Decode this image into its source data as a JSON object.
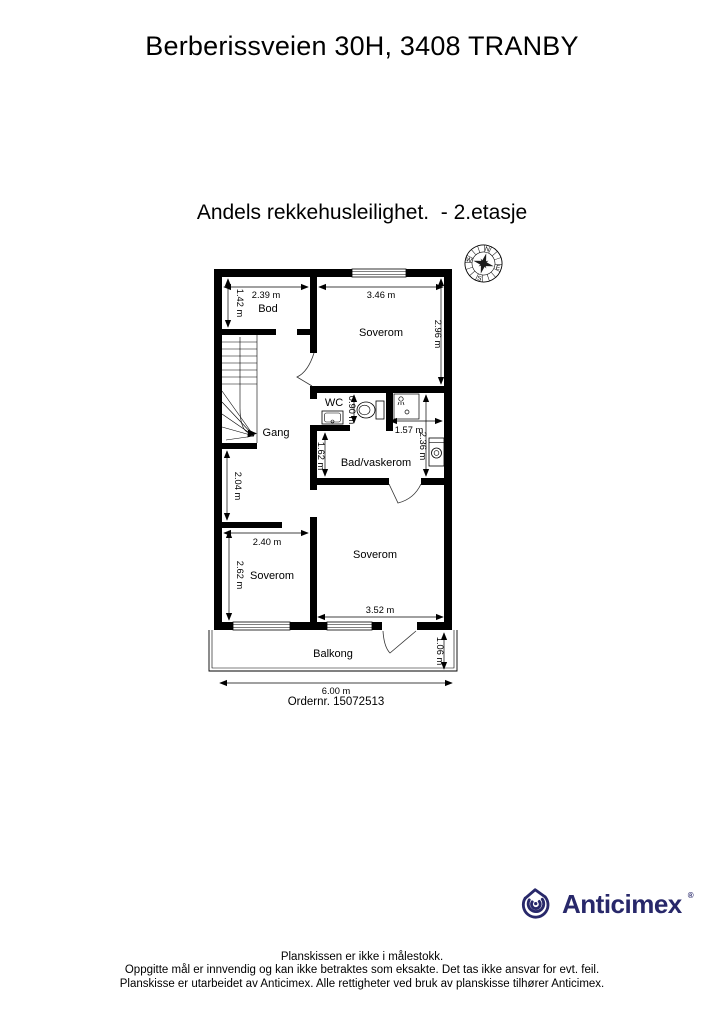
{
  "page": {
    "title": "Berberissveien 30H, 3408 TRANBY",
    "subtitle": "Andels rekkehusleilighet.  - 2.etasje",
    "order_number": "Ordernr. 15072513"
  },
  "compass": {
    "north": "N",
    "east": "E",
    "south": "S",
    "west": "W"
  },
  "plan": {
    "rooms": [
      {
        "name": "bod",
        "label": "Bod"
      },
      {
        "name": "soverom-top",
        "label": "Soverom"
      },
      {
        "name": "wc",
        "label": "WC"
      },
      {
        "name": "gang",
        "label": "Gang"
      },
      {
        "name": "bad-vaskerom",
        "label": "Bad/vaskerom"
      },
      {
        "name": "soverom-left",
        "label": "Soverom"
      },
      {
        "name": "soverom-right",
        "label": "Soverom"
      },
      {
        "name": "balkong",
        "label": "Balkong"
      }
    ],
    "dimensions": [
      {
        "label": "2.39 m"
      },
      {
        "label": "1.42 m"
      },
      {
        "label": "3.46 m"
      },
      {
        "label": "2.96 m"
      },
      {
        "label": "0.90 m"
      },
      {
        "label": "1.57 m"
      },
      {
        "label": "2.36 m"
      },
      {
        "label": "1.62 m"
      },
      {
        "label": "2.04 m"
      },
      {
        "label": "2.40 m"
      },
      {
        "label": "2.62 m"
      },
      {
        "label": "3.52 m"
      },
      {
        "label": "1.06 m"
      },
      {
        "label": "6.00 m"
      }
    ]
  },
  "branding": {
    "logo_text": "Anticimex",
    "registered_mark": "®",
    "brand_color": "#28286a"
  },
  "footer": {
    "lines": [
      "Planskissen er ikke i målestokk.",
      "Oppgitte mål er innvendig og kan ikke betraktes som eksakte. Det tas ikke ansvar for evt. feil.",
      "Planskisse er utarbeidet av Anticimex. Alle rettigheter ved bruk av planskisse tilhører Anticimex."
    ]
  }
}
